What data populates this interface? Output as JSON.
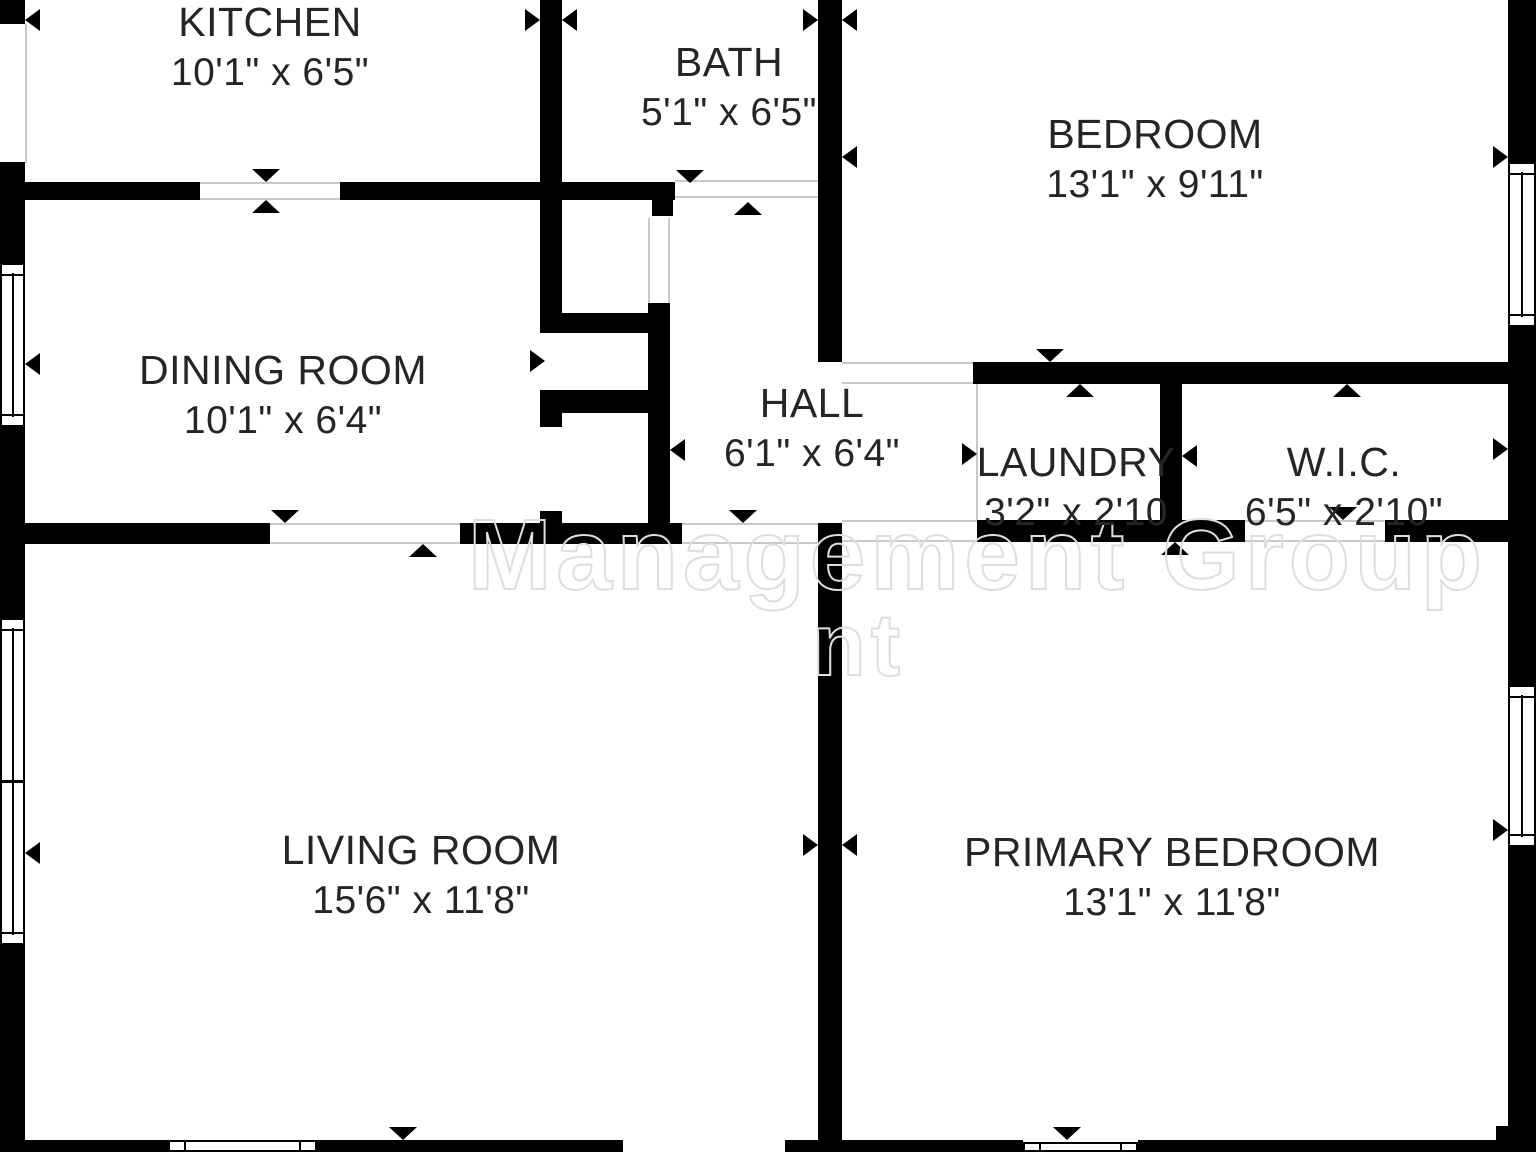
{
  "meta": {
    "title": "Floor plan",
    "background": "#ffffff",
    "wall_color": "#000000",
    "opening_line_color": "#c9c9c9",
    "text_color": "#252525"
  },
  "watermark": {
    "line1": "Management Group",
    "line2_fragment": "nt"
  },
  "rooms": [
    {
      "name": "KITCHEN",
      "dims": "10'1\" x 6'5\"",
      "cx": 270,
      "name_y": 0,
      "dims_y": 52
    },
    {
      "name": "BATH",
      "dims": "5'1\" x 6'5\"",
      "cx": 729,
      "name_y": 40,
      "dims_y": 92
    },
    {
      "name": "BEDROOM",
      "dims": "13'1\" x 9'11\"",
      "cx": 1155,
      "name_y": 112,
      "dims_y": 164
    },
    {
      "name": "DINING ROOM",
      "dims": "10'1\" x 6'4\"",
      "cx": 283,
      "name_y": 348,
      "dims_y": 400
    },
    {
      "name": "HALL",
      "dims": "6'1\" x 6'4\"",
      "cx": 812,
      "name_y": 381,
      "dims_y": 433
    },
    {
      "name": "LAUNDRY",
      "dims": "3'2\" x 2'10",
      "cx": 1076,
      "name_y": 440,
      "dims_y": 492
    },
    {
      "name": "W.I.C.",
      "dims": "6'5\" x 2'10\"",
      "cx": 1344,
      "name_y": 440,
      "dims_y": 492
    },
    {
      "name": "LIVING ROOM",
      "dims": "15'6\" x 11'8\"",
      "cx": 421,
      "name_y": 828,
      "dims_y": 880
    },
    {
      "name": "PRIMARY BEDROOM",
      "dims": "13'1\" x 11'8\"",
      "cx": 1172,
      "name_y": 830,
      "dims_y": 882
    }
  ],
  "walls": [
    {
      "x": 0,
      "y": 0,
      "w": 25,
      "h": 24
    },
    {
      "x": 0,
      "y": 162,
      "w": 25,
      "h": 101
    },
    {
      "x": 0,
      "y": 427,
      "w": 25,
      "h": 191
    },
    {
      "x": 0,
      "y": 945,
      "w": 25,
      "h": 207
    },
    {
      "x": 1508,
      "y": 0,
      "w": 28,
      "h": 162
    },
    {
      "x": 1508,
      "y": 327,
      "w": 28,
      "h": 358
    },
    {
      "x": 1508,
      "y": 847,
      "w": 28,
      "h": 305
    },
    {
      "x": 0,
      "y": 1140,
      "w": 168,
      "h": 12
    },
    {
      "x": 317,
      "y": 1140,
      "w": 306,
      "h": 12
    },
    {
      "x": 785,
      "y": 1140,
      "w": 238,
      "h": 12
    },
    {
      "x": 1138,
      "y": 1140,
      "w": 398,
      "h": 12
    },
    {
      "x": 1496,
      "y": 1126,
      "w": 40,
      "h": 26
    },
    {
      "x": 540,
      "y": 0,
      "w": 22,
      "h": 313
    },
    {
      "x": 818,
      "y": 0,
      "w": 24,
      "h": 362
    },
    {
      "x": 25,
      "y": 182,
      "w": 175,
      "h": 18
    },
    {
      "x": 340,
      "y": 182,
      "w": 335,
      "h": 18
    },
    {
      "x": 540,
      "y": 313,
      "w": 130,
      "h": 20
    },
    {
      "x": 540,
      "y": 390,
      "w": 130,
      "h": 23
    },
    {
      "x": 652,
      "y": 200,
      "w": 21,
      "h": 16
    },
    {
      "x": 648,
      "y": 303,
      "w": 22,
      "h": 220
    },
    {
      "x": 540,
      "y": 413,
      "w": 22,
      "h": 14
    },
    {
      "x": 540,
      "y": 511,
      "w": 22,
      "h": 12
    },
    {
      "x": 25,
      "y": 523,
      "w": 245,
      "h": 21
    },
    {
      "x": 460,
      "y": 523,
      "w": 222,
      "h": 21
    },
    {
      "x": 818,
      "y": 523,
      "w": 24,
      "h": 629
    },
    {
      "x": 973,
      "y": 362,
      "w": 563,
      "h": 22
    },
    {
      "x": 1160,
      "y": 362,
      "w": 22,
      "h": 180
    },
    {
      "x": 977,
      "y": 520,
      "w": 268,
      "h": 22
    },
    {
      "x": 1385,
      "y": 520,
      "w": 123,
      "h": 22
    }
  ],
  "openings": [
    {
      "x": 200,
      "y": 182,
      "w": 140,
      "h": 18,
      "dir": "h"
    },
    {
      "x": 675,
      "y": 180,
      "w": 143,
      "h": 18,
      "dir": "h"
    },
    {
      "x": 270,
      "y": 523,
      "w": 190,
      "h": 21,
      "dir": "h"
    },
    {
      "x": 682,
      "y": 523,
      "w": 136,
      "h": 21,
      "dir": "h"
    },
    {
      "x": 842,
      "y": 362,
      "w": 131,
      "h": 22,
      "dir": "h"
    },
    {
      "x": 842,
      "y": 520,
      "w": 135,
      "h": 22,
      "dir": "h"
    },
    {
      "x": 1245,
      "y": 520,
      "w": 140,
      "h": 22,
      "dir": "h"
    },
    {
      "x": 648,
      "y": 218,
      "w": 22,
      "h": 85,
      "dir": "v"
    }
  ],
  "lines": [
    {
      "x": 25,
      "y": 24,
      "w": 2,
      "h": 139
    },
    {
      "x": 976,
      "y": 384,
      "w": 2,
      "h": 136
    }
  ],
  "windows": [
    {
      "x": 0,
      "y": 263,
      "w": 25,
      "h": 164,
      "type": "v"
    },
    {
      "x": 0,
      "y": 618,
      "w": 25,
      "h": 327,
      "type": "v2"
    },
    {
      "x": 1508,
      "y": 162,
      "w": 28,
      "h": 165,
      "type": "v"
    },
    {
      "x": 1508,
      "y": 685,
      "w": 28,
      "h": 162,
      "type": "v"
    },
    {
      "x": 168,
      "y": 1140,
      "w": 149,
      "h": 12,
      "type": "h"
    },
    {
      "x": 1023,
      "y": 1142,
      "w": 115,
      "h": 10,
      "type": "h"
    }
  ],
  "arrows": [
    {
      "tx": 25,
      "ty": 20,
      "dir": "left"
    },
    {
      "tx": 540,
      "ty": 20,
      "dir": "right"
    },
    {
      "tx": 562,
      "ty": 20,
      "dir": "left"
    },
    {
      "tx": 818,
      "ty": 20,
      "dir": "right"
    },
    {
      "tx": 842,
      "ty": 20,
      "dir": "left"
    },
    {
      "tx": 266,
      "ty": 182,
      "dir": "down"
    },
    {
      "tx": 266,
      "ty": 200,
      "dir": "up"
    },
    {
      "tx": 690,
      "ty": 183,
      "dir": "down"
    },
    {
      "tx": 748,
      "ty": 202,
      "dir": "up"
    },
    {
      "tx": 842,
      "ty": 157,
      "dir": "left"
    },
    {
      "tx": 1508,
      "ty": 157,
      "dir": "right"
    },
    {
      "tx": 25,
      "ty": 364,
      "dir": "left"
    },
    {
      "tx": 545,
      "ty": 361,
      "dir": "right"
    },
    {
      "tx": 670,
      "ty": 450,
      "dir": "left"
    },
    {
      "tx": 977,
      "ty": 454,
      "dir": "right"
    },
    {
      "tx": 1160,
      "ty": 456,
      "dir": "left"
    },
    {
      "tx": 1182,
      "ty": 456,
      "dir": "left"
    },
    {
      "tx": 1508,
      "ty": 449,
      "dir": "right"
    },
    {
      "tx": 1347,
      "ty": 384,
      "dir": "up"
    },
    {
      "tx": 1343,
      "ty": 520,
      "dir": "down"
    },
    {
      "tx": 1175,
      "ty": 542,
      "dir": "up"
    },
    {
      "tx": 1050,
      "ty": 362,
      "dir": "down"
    },
    {
      "tx": 1080,
      "ty": 384,
      "dir": "up"
    },
    {
      "tx": 285,
      "ty": 523,
      "dir": "down"
    },
    {
      "tx": 423,
      "ty": 544,
      "dir": "up"
    },
    {
      "tx": 743,
      "ty": 523,
      "dir": "down"
    },
    {
      "tx": 25,
      "ty": 853,
      "dir": "left"
    },
    {
      "tx": 818,
      "ty": 845,
      "dir": "right"
    },
    {
      "tx": 842,
      "ty": 845,
      "dir": "left"
    },
    {
      "tx": 1508,
      "ty": 830,
      "dir": "right"
    },
    {
      "tx": 403,
      "ty": 1140,
      "dir": "down"
    },
    {
      "tx": 1067,
      "ty": 1140,
      "dir": "down"
    }
  ]
}
